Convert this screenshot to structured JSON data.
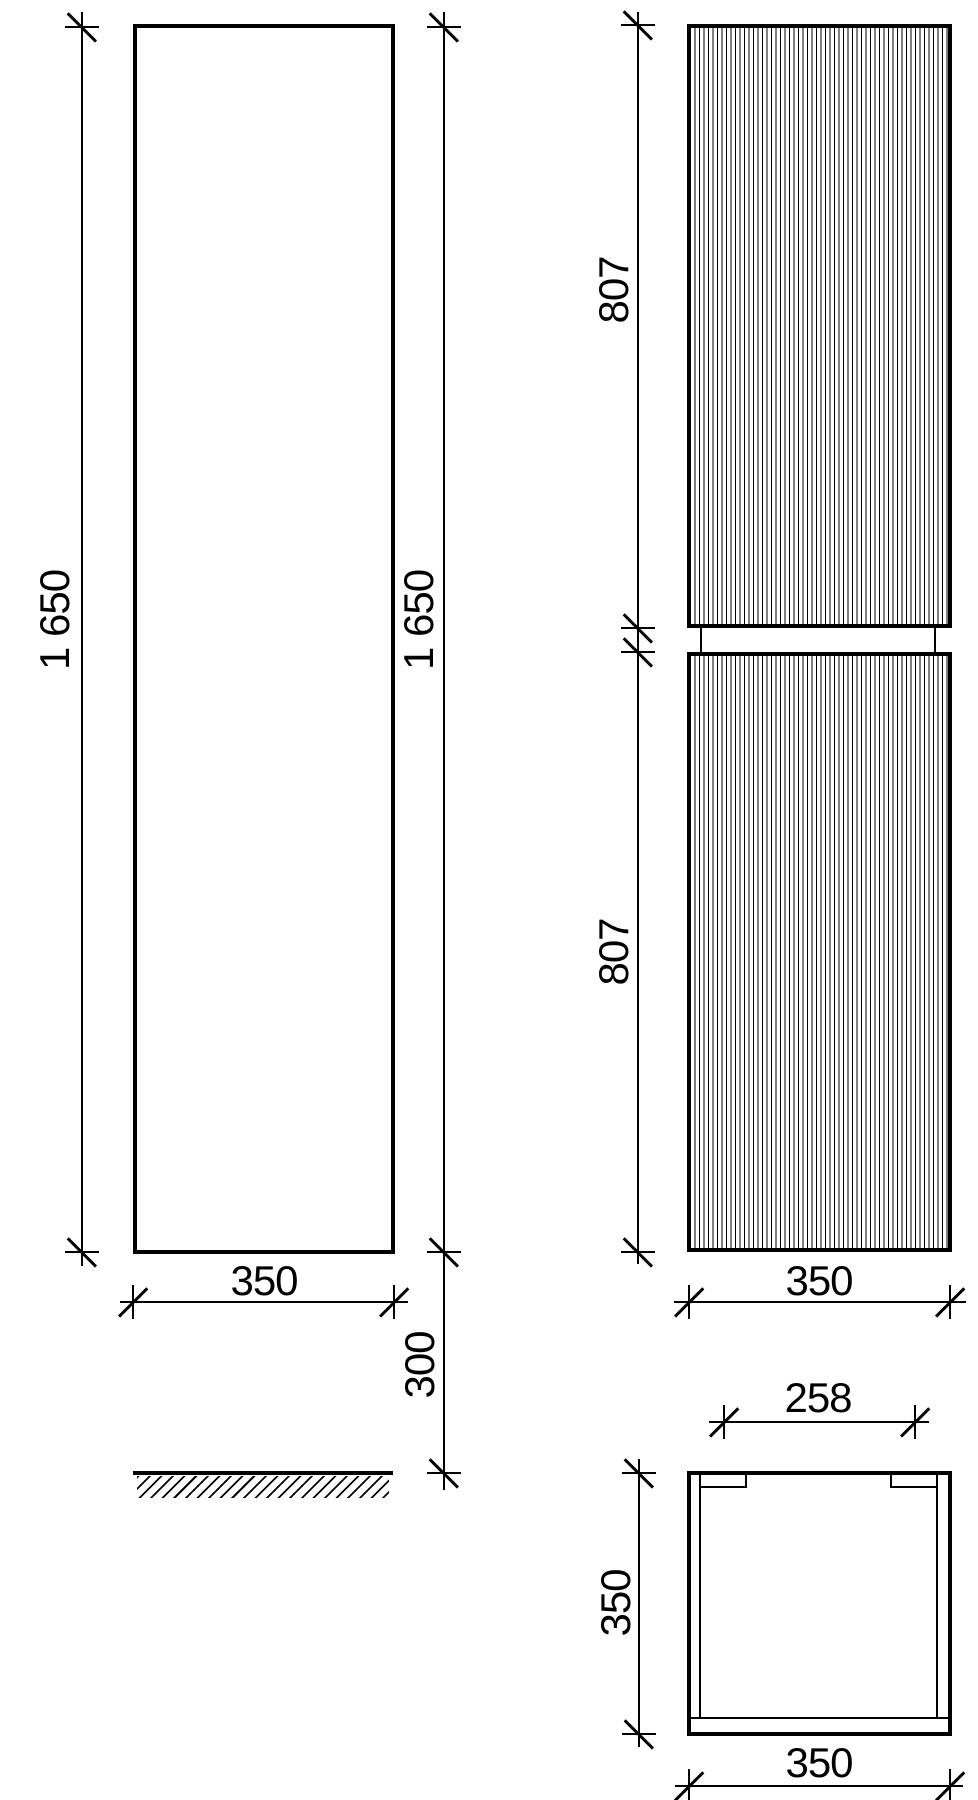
{
  "title": "cabinet-dimension-drawing",
  "colors": {
    "line": "#000000",
    "background": "#ffffff"
  },
  "views": {
    "side": {
      "label": "side-view",
      "height_left": "1 650",
      "height_right": "1 650",
      "width": "350",
      "floor_gap": "300"
    },
    "front": {
      "label": "front-view",
      "door_top_height": "807",
      "door_bottom_height": "807",
      "width": "350"
    },
    "top": {
      "label": "top-view",
      "opening_width": "258",
      "depth": "350",
      "width": "350"
    }
  }
}
